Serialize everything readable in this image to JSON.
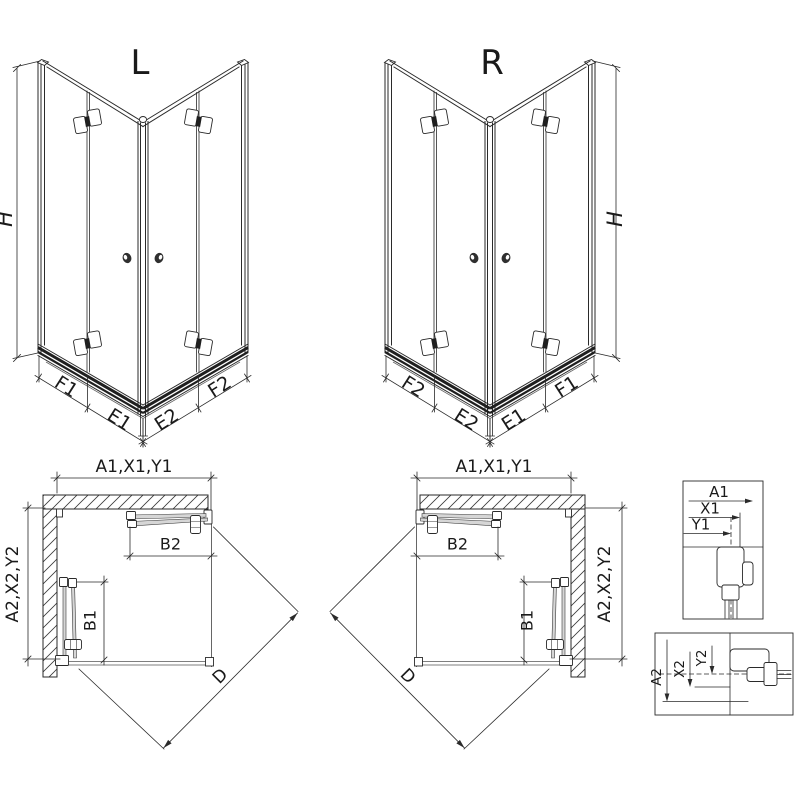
{
  "views": {
    "iso_left": {
      "label": "L",
      "dims": {
        "height": "H",
        "outer_left": "F1",
        "inner_left": "E1",
        "inner_right": "E2",
        "outer_right": "F2"
      }
    },
    "iso_right": {
      "label": "R",
      "dims": {
        "height": "H",
        "outer_left": "F2",
        "inner_left": "E2",
        "inner_right": "E1",
        "outer_right": "F1"
      }
    },
    "plan_left": {
      "dims": {
        "top": "A1,X1,Y1",
        "side": "A2,X2,Y2",
        "door_top": "B2",
        "door_side": "B1",
        "diagonal": "D"
      }
    },
    "plan_right": {
      "dims": {
        "top": "A1,X1,Y1",
        "side": "A2,X2,Y2",
        "door_top": "B2",
        "door_side": "B1",
        "diagonal": "D"
      }
    },
    "detail_width": {
      "dims": [
        "A1",
        "X1",
        "Y1"
      ]
    },
    "detail_depth": {
      "dims": [
        "A2",
        "X2",
        "Y2"
      ]
    }
  },
  "colors": {
    "line": "#2a2a2a",
    "glass": "#d6d6d6",
    "background": "#ffffff"
  }
}
